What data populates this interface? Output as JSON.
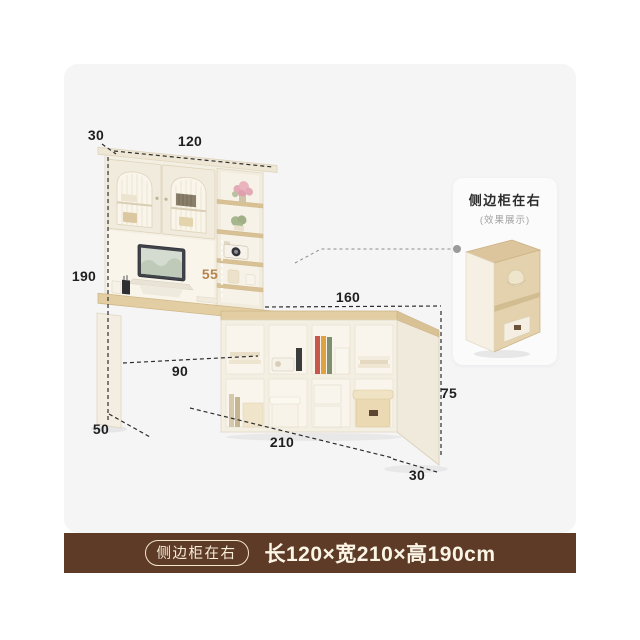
{
  "dims": {
    "top_depth": "30",
    "top_width": "120",
    "total_height": "190",
    "hutch_clearance": "55",
    "desk_width": "90",
    "desk_depth": "50",
    "shelf_top_width": "160",
    "shelf_height": "75",
    "shelf_total_width": "210",
    "shelf_depth": "30"
  },
  "side_panel": {
    "title": "侧边柜在右",
    "subtitle": "(效果展示)"
  },
  "footer": {
    "badge": "侧边柜在右",
    "size_text": "长120×宽210×高190cm"
  },
  "colors": {
    "footer_bg": "#5d3b27",
    "footer_text": "#fcf5e6",
    "accent_dim": "#b5854d",
    "dim_text": "#1f1f1f",
    "card_bg": "#f5f5f6",
    "wood": "#e3cea3"
  }
}
